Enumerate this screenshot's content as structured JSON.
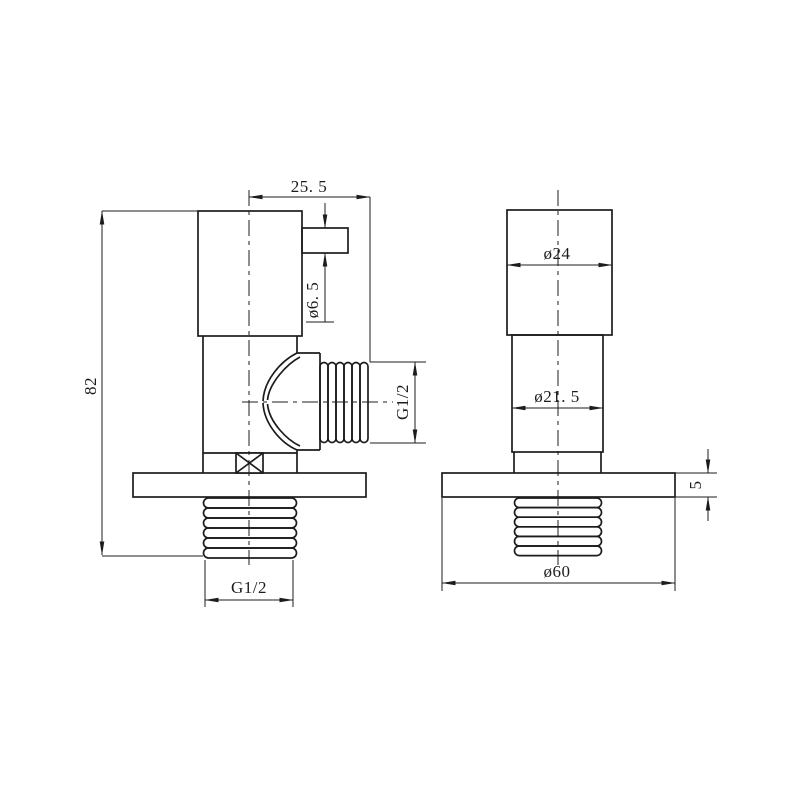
{
  "canvas": {
    "background": "#ffffff",
    "line_color": "#1c1c1c"
  },
  "drawing": {
    "title": "angle valve technical drawing, two orthographic views",
    "left_view": {
      "label": "side profile view",
      "dims": {
        "top_width": "25. 5",
        "outlet_bore": "ø6. 5",
        "overall_height": "82",
        "outlet_thread": "G1/2",
        "inlet_thread": "G1/2"
      }
    },
    "right_view": {
      "label": "front view",
      "dims": {
        "handle_diameter": "ø24",
        "body_diameter": "ø21. 5",
        "flange_thickness": "5",
        "flange_diameter": "ø60"
      }
    }
  }
}
